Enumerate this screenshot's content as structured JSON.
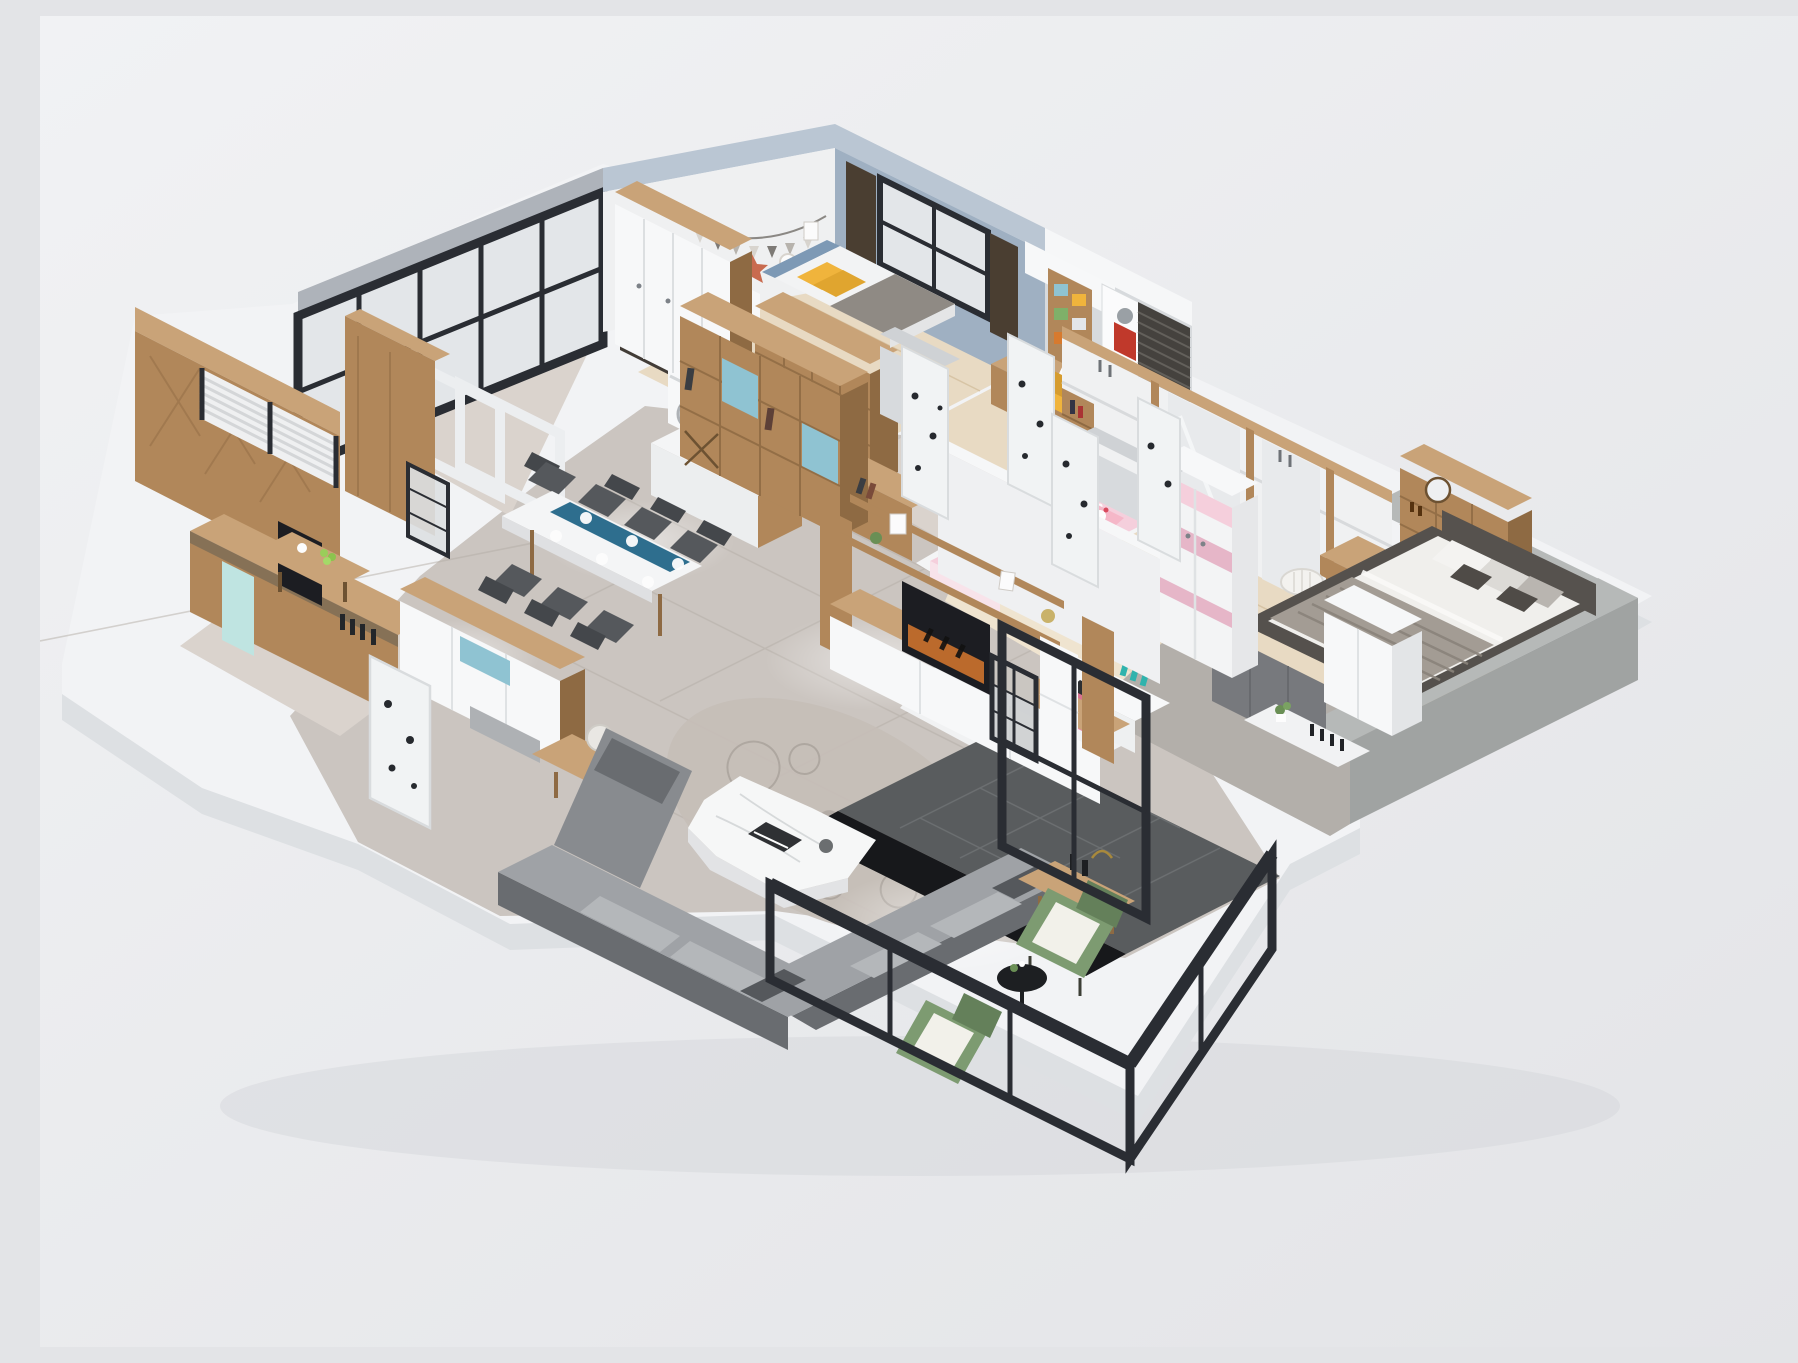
{
  "scene": {
    "description": "3D isometric cutaway rendering of a furnished apartment floor plan",
    "rooms": [
      "teen-bedroom",
      "study",
      "laundry-kitchen",
      "tea-room",
      "dining-area",
      "entry",
      "living-room",
      "hallway",
      "kids-bedroom",
      "master-bedroom",
      "balcony"
    ]
  },
  "palette": {
    "bg-top": "#f1f2f4",
    "bg-bottom": "#e3e4e7",
    "base": "#f2f3f5",
    "base-side": "#dde0e3",
    "ground-shadow": "#d3d5d9",
    "marble": "#cbc5c0",
    "marble-light": "#dad3cd",
    "marble-line": "#b5aea7",
    "floor-wood": "#e8dac3",
    "floor-wood-line": "#d3bf9e",
    "pale-wood": "#efe4d0",
    "wall-white": "#eff0f1",
    "wall-top": "#f6f7f8",
    "wall-shadow": "#d7dadd",
    "wall-blue": "#9fb0c2",
    "wall-blue-top": "#bac6d3",
    "wood": "#b1875a",
    "wood-light": "#c9a378",
    "wood-dark": "#8e6a43",
    "wood-deep": "#6d5232",
    "metal": "#2a2d33",
    "glass": "#e3e6e9",
    "sill": "#aeb3ba",
    "sofa": "#888b8f",
    "sofa-dark": "#696c70",
    "sofa-light": "#9fa2a6",
    "cushion": "#b4b7ba",
    "white": "#f7f8f9",
    "yellow": "#f0b43c",
    "blue-accent": "#8fc3d2",
    "teal": "#2fb3ad",
    "runner-blue": "#2e6e8e",
    "pink": "#f5cfdc",
    "pink-dark": "#e3aabf",
    "pink-chair": "#e887a6",
    "green": "#7d9b71",
    "green-dark": "#64805a",
    "gray-wall": "#b6b9b8",
    "gray-wall-dark": "#a0a3a2",
    "rug": "#b3afaa",
    "tile-dark": "#595c5e",
    "tile-line": "#6e7173",
    "marble-black": "#17181b",
    "bed-frame": "#55514d",
    "duvet": "#f0efec",
    "blanket": "#a39c94",
    "blanket-line": "#8a837b",
    "counter-dark": "#423c37",
    "poster-dark": "#1c1d22",
    "poster-orange": "#d7782e",
    "curtain": "#4a3e31",
    "door-white": "#f1f3f4",
    "door-line": "#d9dcde",
    "chair-dark": "#55585c",
    "chair-darker": "#44474b",
    "mint": "#bfe4e1",
    "laptop": "#2c2e31",
    "granite": "#6f6554"
  }
}
